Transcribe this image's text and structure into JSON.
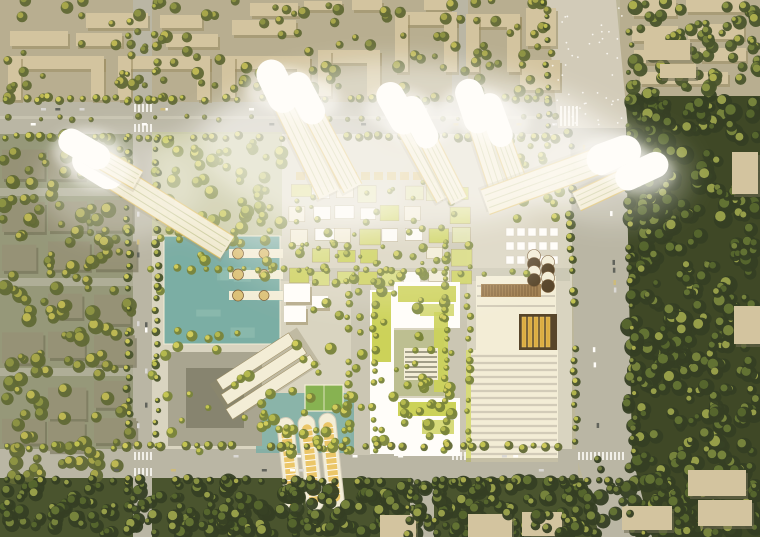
{
  "scene": {
    "type": "aerial-architectural-render",
    "description": "Top-down aerial rendering of an urban regeneration masterplan: a sun-bleached district of white leaning towers around a tree-lined central promenade, teal water plazas with round pier pavilions, a green-roofed courtyard block, a white ribbed exhibition hall with gold skylights, three barrel-vaulted greenhouses, framed by beige perimeter housing blocks, boulevards and a dense dark-green urban forest to the east.",
    "time_of_day": "daytime, strong warm sun from the upper left, bleached white highlights",
    "view": "top-down aerial, slight perspective tilt",
    "palette": {
      "ground": "#b9b49a",
      "ground_left": "#8e9377",
      "ground_top": "#b3ab90",
      "ground_dev": "#d7d3c3",
      "ground_bottom": "#3d4a26",
      "road": "#b5b3a5",
      "road_light": "#cfcabb",
      "road_internal": "#c7c4b5",
      "block_beige": "#cfc2a0",
      "block_beige_shadow": "#94865e",
      "block_gray": "#8f8c74",
      "block_gray_shadow": "#64634d",
      "forest_base": "#313d1e",
      "water": "#74aaa4",
      "water_light": "#8fc0b6",
      "roof_green": "#c9d158",
      "roof_green2": "#d4da7a",
      "roof_pale": "#dfe3ac",
      "white": "#ffffff",
      "cream": "#f3eedb",
      "gold": "#d8a93f",
      "gold_light": "#e9c468",
      "gold_dark": "#4a3a22",
      "louvre": "#9b7a4e",
      "louvre_dark": "#6b4f2e",
      "pier_disc": "#d9bf78",
      "court": "#b9bd92",
      "sport": "#7fae4e",
      "school": "#a3a190",
      "school_court": "#7e7d6c",
      "tower_body": "#f3ecd4",
      "tower_stripe": "#a9b073",
      "tower_edge": "#d9b54f",
      "tower_shadow": "#8a8468",
      "glow": "#ffffff",
      "tint": "#ffe9b0",
      "tree_dark_base": "#26331a",
      "tree_dark_hi": [
        "#4e6128",
        "#5d7030",
        "#74843a",
        "#9aa44a"
      ],
      "tree_mid_base": "#3c4a24",
      "tree_mid_hi": [
        "#6b7b36",
        "#8a9642",
        "#b0b44e"
      ],
      "tree_olive_base": "#55602e",
      "tree_olive_hi": [
        "#8a9140",
        "#c2bd54",
        "#a8a848"
      ],
      "tree_bright_base": "#6f7c35",
      "tree_bright_hi": [
        "#b6bb4e",
        "#d8d45e",
        "#c9cb52"
      ],
      "car_colors": [
        "#ffffff",
        "#d8d8d8",
        "#555a55",
        "#c9b87a"
      ]
    },
    "regions": [
      {
        "name": "perimeter-housing-north",
        "desc": "beige slab and U-shaped apartment blocks with courtyards and street trees"
      },
      {
        "name": "perimeter-housing-west",
        "desc": "gray housing blocks in dense olive tree cover"
      },
      {
        "name": "urban-forest-east",
        "desc": "dense dark-green tree canopy with a few pavilion roofs"
      },
      {
        "name": "forest-belt-south",
        "desc": "tree belt along the southern boulevard with scattered buildings"
      },
      {
        "name": "central-development",
        "desc": "sun-bleached new quarter with low village blocks, water plazas and towers"
      },
      {
        "name": "grand-avenue-northeast",
        "desc": "wide light pedestrian boulevard exiting the frame top right"
      },
      {
        "name": "ring-boulevards",
        "desc": "tree-lined vehicular roads framing the site on all four sides"
      }
    ],
    "landmarks": [
      {
        "name": "glowing-towers",
        "count": 10,
        "desc": "white high-rise slabs leaning outward, tops bleached by sunlight"
      },
      {
        "name": "water-plaza",
        "desc": "teal reflecting pool with three white piers and round tan pavilions"
      },
      {
        "name": "village-blocks",
        "desc": "grid of small pale blocks with chartreuse-green roofs and market stalls"
      },
      {
        "name": "green-roof-courtyard-building",
        "desc": "C-shaped white building with chartreuse roof strips around a planted court"
      },
      {
        "name": "ribbed-exhibition-hall",
        "desc": "large white hall with parallel roof ribs, gold skylight bars, totem discs and a timber louvre deck"
      },
      {
        "name": "barrel-greenhouses",
        "count": 3,
        "desc": "three barrel-vaulted glasshouses with pale-gold interiors"
      },
      {
        "name": "terraced-slab-building",
        "desc": "three stepped white bars set diagonally beside the pool"
      },
      {
        "name": "sports-court",
        "desc": "small green court with white markings"
      }
    ]
  }
}
